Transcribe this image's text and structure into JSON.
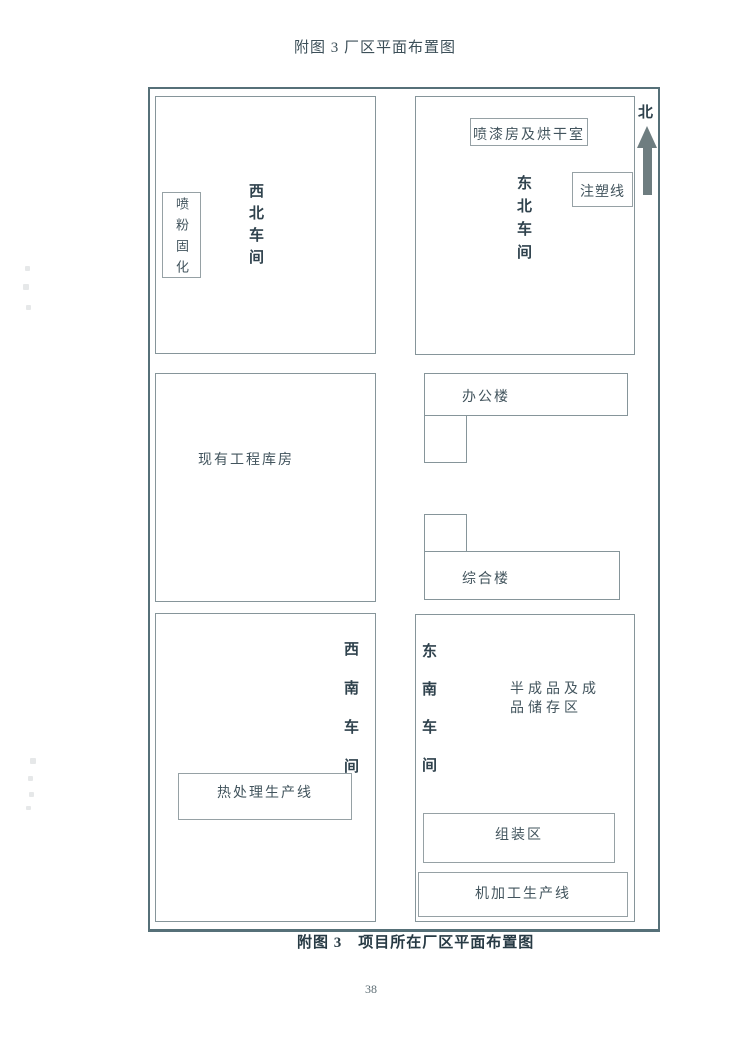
{
  "page": {
    "title": "附图 3 厂区平面布置图",
    "caption": "附图 3　项目所在厂区平面布置图",
    "page_number": "38"
  },
  "compass": {
    "north_label": "北"
  },
  "buildings": {
    "nw_workshop": {
      "name": "西北车间",
      "powder_curing": "喷粉固化"
    },
    "ne_workshop": {
      "name": "东北车间",
      "spray_paint_room": "喷漆房及烘干室",
      "injection_line": "注塑线"
    },
    "warehouse": {
      "name": "现有工程库房"
    },
    "office_building": {
      "name": "办公楼"
    },
    "complex_building": {
      "name": "综合楼"
    },
    "sw_workshop": {
      "name": "西南车间",
      "heat_treatment_line": "热处理生产线"
    },
    "se_workshop": {
      "name": "东南车间",
      "storage_area": "半成品及成品储存区",
      "assembly_area": "组装区",
      "machining_line": "机加工生产线"
    }
  },
  "colors": {
    "outer_border": "#567078",
    "building_border": "#86959a",
    "text": "#42545d",
    "bold_text": "#2f424d",
    "north_arrow": "#6e7d80"
  }
}
